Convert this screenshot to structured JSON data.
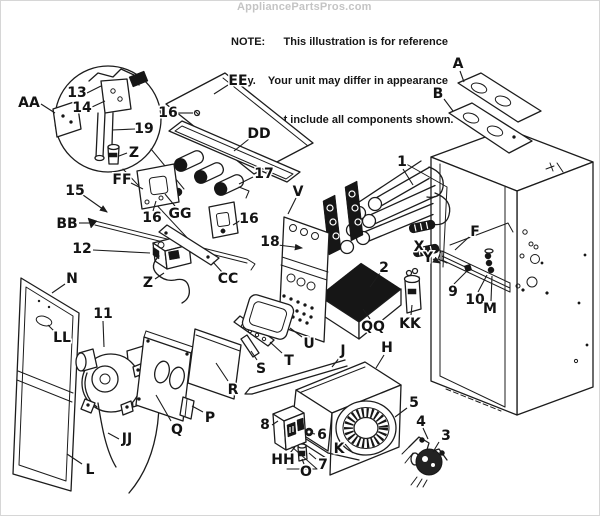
{
  "watermark": {
    "text": "AppliancePartsPros.com"
  },
  "note": {
    "line1": "NOTE:      This illustration is for reference",
    "line2": "only.    Your unit may differ in appearance",
    "line3": "or may not include all components shown."
  },
  "colors": {
    "ink": "#1c1c1c",
    "watermark": "#c4c4c4",
    "paper": "#ffffff"
  },
  "diagram": {
    "description": "Exploded parts diagram of a gas furnace",
    "labels": [
      {
        "t": "AA",
        "x": 28,
        "y": 101,
        "line": [
          40,
          103,
          54,
          112
        ]
      },
      {
        "t": "13",
        "x": 76,
        "y": 91,
        "line": [
          86,
          92,
          100,
          85
        ]
      },
      {
        "t": "14",
        "x": 81,
        "y": 106,
        "line": [
          91,
          106,
          104,
          100
        ]
      },
      {
        "t": "19",
        "x": 143,
        "y": 127,
        "line": [
          134,
          128,
          111,
          129
        ]
      },
      {
        "t": "Z",
        "x": 133,
        "y": 151,
        "line": [
          126,
          152,
          118,
          155
        ]
      },
      {
        "t": "16",
        "x": 167,
        "y": 111,
        "line": [
          176,
          112,
          192,
          112
        ]
      },
      {
        "t": "EE",
        "x": 237,
        "y": 79,
        "line": [
          227,
          84,
          213,
          93
        ]
      },
      {
        "t": "DD",
        "x": 258,
        "y": 132,
        "line": [
          248,
          138,
          233,
          150
        ]
      },
      {
        "t": "17",
        "x": 263,
        "y": 172,
        "line": [
          252,
          176,
          238,
          183
        ]
      },
      {
        "t": "FF",
        "x": 121,
        "y": 178,
        "line": [
          130,
          182,
          142,
          188
        ]
      },
      {
        "t": "15",
        "x": 74,
        "y": 189,
        "line": [
          82,
          194,
          106,
          211
        ],
        "arrow": true
      },
      {
        "t": "BB",
        "x": 66,
        "y": 222,
        "line": [
          78,
          222,
          91,
          222
        ]
      },
      {
        "t": "16",
        "x": 151,
        "y": 216,
        "line": [
          152,
          210,
          155,
          200
        ]
      },
      {
        "t": "GG",
        "x": 179,
        "y": 212,
        "line": [
          174,
          205,
          164,
          193
        ]
      },
      {
        "t": "16",
        "x": 248,
        "y": 217,
        "line": [
          240,
          219,
          232,
          224
        ]
      },
      {
        "t": "12",
        "x": 81,
        "y": 247,
        "line": [
          92,
          249,
          149,
          252
        ]
      },
      {
        "t": "Z",
        "x": 147,
        "y": 281,
        "line": [
          154,
          278,
          163,
          272
        ]
      },
      {
        "t": "CC",
        "x": 227,
        "y": 277,
        "line": [
          221,
          271,
          212,
          261
        ]
      },
      {
        "t": "18",
        "x": 269,
        "y": 240,
        "line": [
          277,
          244,
          301,
          247
        ],
        "arrow": true
      },
      {
        "t": "V",
        "x": 297,
        "y": 190,
        "line": [
          295,
          197,
          287,
          213
        ]
      },
      {
        "t": "1",
        "x": 401,
        "y": 160,
        "line": [
          402,
          168,
          412,
          184
        ]
      },
      {
        "t": "A",
        "x": 457,
        "y": 62,
        "line": [
          459,
          70,
          463,
          81
        ]
      },
      {
        "t": "B",
        "x": 437,
        "y": 92,
        "line": [
          443,
          98,
          452,
          110
        ]
      },
      {
        "t": "F",
        "x": 474,
        "y": 230,
        "line": [
          468,
          236,
          454,
          249
        ]
      },
      {
        "t": "X",
        "x": 418,
        "y": 245,
        "line": [
          424,
          248,
          431,
          252
        ],
        "arrow": true
      },
      {
        "t": "Y",
        "x": 427,
        "y": 256,
        "line": [
          432,
          258,
          439,
          262
        ],
        "arrow": true
      },
      {
        "t": "9",
        "x": 452,
        "y": 290,
        "line": [
          453,
          283,
          466,
          270
        ]
      },
      {
        "t": "10",
        "x": 474,
        "y": 298,
        "line": [
          477,
          291,
          486,
          274
        ]
      },
      {
        "t": "M",
        "x": 489,
        "y": 307,
        "line": [
          490,
          300,
          491,
          275
        ]
      },
      {
        "t": "2",
        "x": 383,
        "y": 266,
        "line": [
          379,
          272,
          369,
          286
        ]
      },
      {
        "t": "QQ",
        "x": 372,
        "y": 325,
        "line": [
          369,
          318,
          362,
          308
        ]
      },
      {
        "t": "KK",
        "x": 409,
        "y": 322,
        "line": [
          410,
          314,
          411,
          304
        ]
      },
      {
        "t": "N",
        "x": 71,
        "y": 277,
        "line": [
          64,
          283,
          51,
          292
        ]
      },
      {
        "t": "LL",
        "x": 61,
        "y": 336,
        "line": [
          54,
          331,
          47,
          324
        ]
      },
      {
        "t": "11",
        "x": 102,
        "y": 312,
        "line": [
          102,
          320,
          103,
          346
        ]
      },
      {
        "t": "JJ",
        "x": 126,
        "y": 437,
        "line": [
          118,
          438,
          107,
          432
        ]
      },
      {
        "t": "L",
        "x": 89,
        "y": 468,
        "line": [
          81,
          463,
          66,
          453
        ]
      },
      {
        "t": "Q",
        "x": 176,
        "y": 428,
        "line": [
          170,
          420,
          155,
          394
        ]
      },
      {
        "t": "P",
        "x": 209,
        "y": 416,
        "line": [
          202,
          411,
          191,
          405
        ]
      },
      {
        "t": "R",
        "x": 232,
        "y": 388,
        "line": [
          227,
          380,
          215,
          362
        ]
      },
      {
        "t": "S",
        "x": 260,
        "y": 367,
        "line": [
          256,
          359,
          250,
          350
        ]
      },
      {
        "t": "T",
        "x": 288,
        "y": 359,
        "line": [
          281,
          352,
          269,
          341
        ]
      },
      {
        "t": "U",
        "x": 308,
        "y": 342,
        "line": [
          301,
          336,
          289,
          327
        ]
      },
      {
        "t": "J",
        "x": 342,
        "y": 349,
        "line": [
          339,
          356,
          331,
          366
        ]
      },
      {
        "t": "H",
        "x": 386,
        "y": 346,
        "line": [
          383,
          354,
          375,
          367
        ]
      },
      {
        "t": "8",
        "x": 264,
        "y": 423,
        "line": [
          271,
          424,
          277,
          420
        ]
      },
      {
        "t": "6",
        "x": 321,
        "y": 433,
        "line": [
          314,
          433,
          309,
          432
        ]
      },
      {
        "t": "K",
        "x": 338,
        "y": 447,
        "line": [
          344,
          443,
          352,
          452
        ]
      },
      {
        "t": "HH",
        "x": 282,
        "y": 458,
        "line": [
          289,
          452,
          294,
          446
        ]
      },
      {
        "t": "O",
        "x": 305,
        "y": 470,
        "line": [
          303,
          463,
          301,
          458
        ]
      },
      {
        "t": "7",
        "x": 322,
        "y": 463,
        "line": [
          315,
          458,
          308,
          452
        ]
      },
      {
        "t": "5",
        "x": 413,
        "y": 401,
        "line": [
          406,
          407,
          394,
          416
        ]
      },
      {
        "t": "4",
        "x": 420,
        "y": 420,
        "line": [
          422,
          427,
          427,
          438
        ]
      },
      {
        "t": "3",
        "x": 445,
        "y": 434,
        "line": [
          438,
          441,
          432,
          451
        ]
      }
    ]
  }
}
